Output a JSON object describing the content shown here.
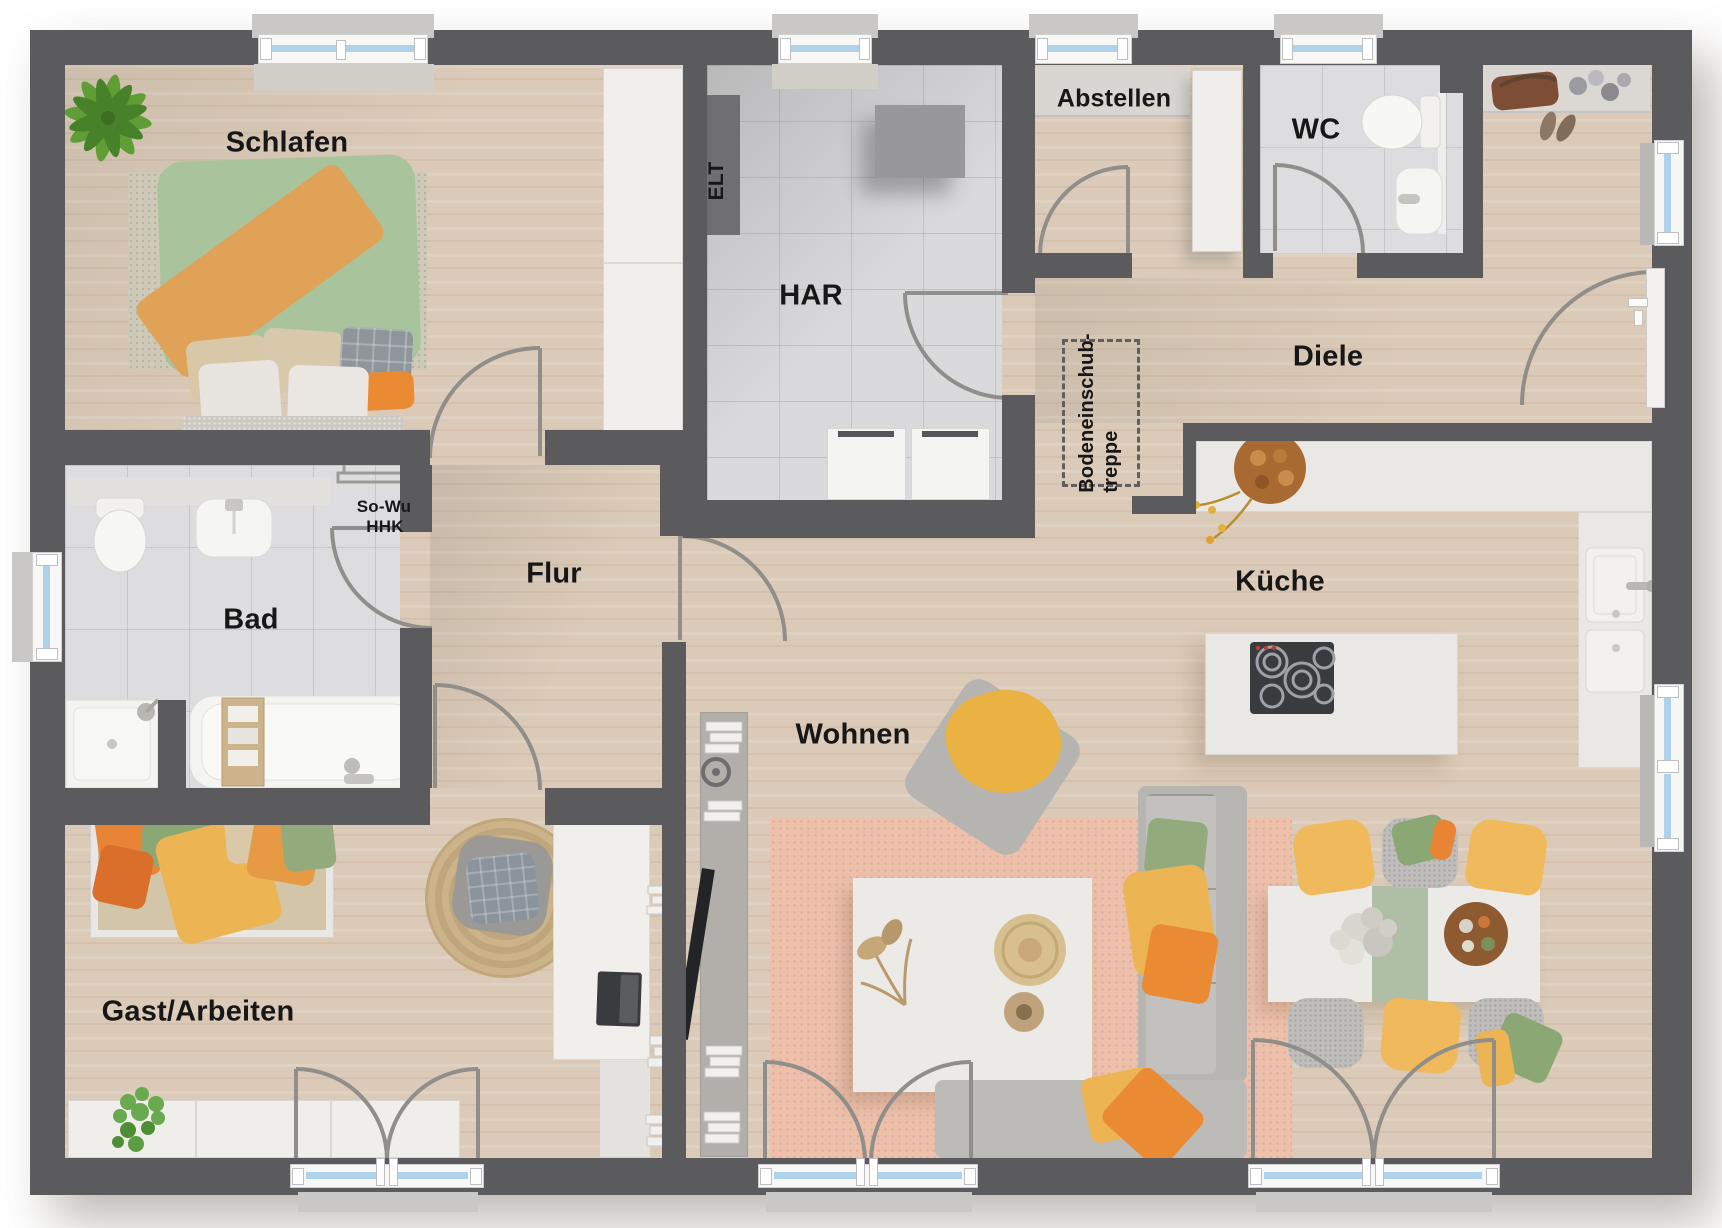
{
  "plan_title": "Erdgeschoss Grundriss Bungalow",
  "rooms": {
    "schlafen": "Schlafen",
    "har": "HAR",
    "abstellen": "Abstellen",
    "wc": "WC",
    "diele": "Diele",
    "bad": "Bad",
    "flur": "Flur",
    "wohnen": "Wohnen",
    "kueche": "Küche",
    "gast": "Gast/Arbeiten"
  },
  "annotations": {
    "elt": "ELT",
    "so_wu": "So-Wu",
    "hhk": "HHK",
    "attic_line1": "Bodeneinschub-",
    "attic_line2": "treppe"
  },
  "colors": {
    "wall": "#5b5b5e",
    "wood_floor": "#dbcab7",
    "tile_floor": "#dadadd",
    "window_glazing": "#aed2e9",
    "rug_salmon": "#eec0a9",
    "accent_orange": "#ea8b33",
    "accent_yellow": "#eeb95c",
    "accent_green": "#93ab7c"
  }
}
